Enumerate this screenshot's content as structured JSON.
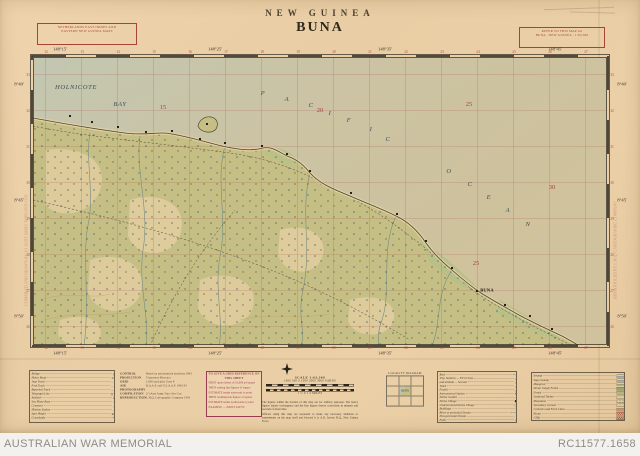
{
  "header": {
    "country": "NEW GUINEA",
    "title": "BUNA",
    "series_note_lines": [
      "NETHERLANDS EAST INDIES AND",
      "EASTERN NEW GUINEA MAPS"
    ],
    "refer_note_lines": [
      "REFER TO THIS MAP AS",
      "BUNA . NEW GUINEA . 1:63,360"
    ]
  },
  "map": {
    "float_labels": [
      {
        "t": "HOLNICOTE",
        "x": 76,
        "y": 87,
        "c": "sea"
      },
      {
        "t": "BAY",
        "x": 120,
        "y": 104,
        "c": "sea"
      },
      {
        "t": "P",
        "x": 263,
        "y": 93,
        "c": "sea"
      },
      {
        "t": "A",
        "x": 287,
        "y": 99,
        "c": "sea"
      },
      {
        "t": "C",
        "x": 311,
        "y": 105,
        "c": "sea"
      },
      {
        "t": "I",
        "x": 330,
        "y": 113,
        "c": "sea"
      },
      {
        "t": "F",
        "x": 349,
        "y": 120,
        "c": "sea"
      },
      {
        "t": "I",
        "x": 371,
        "y": 129,
        "c": "sea"
      },
      {
        "t": "C",
        "x": 388,
        "y": 139,
        "c": "sea"
      },
      {
        "t": "O",
        "x": 449,
        "y": 171,
        "c": "sea"
      },
      {
        "t": "C",
        "x": 470,
        "y": 184,
        "c": "sea"
      },
      {
        "t": "E",
        "x": 489,
        "y": 197,
        "c": "sea"
      },
      {
        "t": "A",
        "x": 508,
        "y": 210,
        "c": "sea"
      },
      {
        "t": "N",
        "x": 528,
        "y": 224,
        "c": "sea"
      },
      {
        "t": "15",
        "x": 163,
        "y": 107,
        "c": "grid"
      },
      {
        "t": "20",
        "x": 320,
        "y": 110,
        "c": "grid"
      },
      {
        "t": "25",
        "x": 469,
        "y": 104,
        "c": "grid"
      },
      {
        "t": "30",
        "x": 552,
        "y": 187,
        "c": "grid"
      },
      {
        "t": "25",
        "x": 476,
        "y": 263,
        "c": "grid"
      },
      {
        "t": "BUNA",
        "x": 487,
        "y": 290,
        "c": "place"
      },
      {
        "t": "148°15'",
        "x": 60,
        "y": 49,
        "c": "coord"
      },
      {
        "t": "148°25'",
        "x": 215,
        "y": 49,
        "c": "coord"
      },
      {
        "t": "148°35'",
        "x": 385,
        "y": 49,
        "c": "coord"
      },
      {
        "t": "148°45'",
        "x": 555,
        "y": 49,
        "c": "coord"
      },
      {
        "t": "148°15'",
        "x": 60,
        "y": 353,
        "c": "coord"
      },
      {
        "t": "148°25'",
        "x": 215,
        "y": 353,
        "c": "coord"
      },
      {
        "t": "148°35'",
        "x": 385,
        "y": 353,
        "c": "coord"
      },
      {
        "t": "148°45'",
        "x": 555,
        "y": 353,
        "c": "coord"
      },
      {
        "t": "8°40'",
        "x": 19,
        "y": 84,
        "c": "coord"
      },
      {
        "t": "8°45'",
        "x": 19,
        "y": 200,
        "c": "coord"
      },
      {
        "t": "8°50'",
        "x": 19,
        "y": 316,
        "c": "coord"
      },
      {
        "t": "8°40'",
        "x": 622,
        "y": 84,
        "c": "coord"
      },
      {
        "t": "8°45'",
        "x": 622,
        "y": 200,
        "c": "coord"
      },
      {
        "t": "8°50'",
        "x": 622,
        "y": 316,
        "c": "coord"
      },
      {
        "t": "COMPILED AND DRAWN BY 2/1 AUST ARMY TOPO SVY COY",
        "x": 26,
        "y": 250,
        "c": "vert"
      },
      {
        "t": "REPRODUCED BY L.H.Q. CARTOGRAPHIC COMPANY",
        "x": 615,
        "y": 250,
        "c": "vert"
      }
    ],
    "edge_numbers": {
      "horizontal": {
        "x0": 46,
        "dx": 36,
        "n": 16,
        "v0": 12,
        "step": 1,
        "ys": [
          52,
          348
        ]
      },
      "vertical": {
        "y0": 75,
        "dy": 36,
        "n": 8,
        "v0": 33,
        "step": -1,
        "xs": [
          28,
          612
        ]
      }
    },
    "villages": [
      [
        70,
        116
      ],
      [
        92,
        122
      ],
      [
        118,
        127
      ],
      [
        146,
        132
      ],
      [
        172,
        131
      ],
      [
        200,
        139
      ],
      [
        225,
        143
      ],
      [
        262,
        146
      ],
      [
        287,
        154
      ],
      [
        310,
        171
      ],
      [
        351,
        193
      ],
      [
        397,
        214
      ],
      [
        426,
        241
      ],
      [
        452,
        268
      ],
      [
        477,
        291
      ],
      [
        505,
        305
      ],
      [
        530,
        316
      ],
      [
        552,
        329
      ],
      [
        207,
        124
      ]
    ]
  },
  "legend_left": {
    "rows": [
      {
        "label": "Bridge",
        "sym": "bridge"
      },
      {
        "label": "Motor Road",
        "sym": "road"
      },
      {
        "label": "Jeep Track",
        "sym": "jeep"
      },
      {
        "label": "Foot Track",
        "sym": "foot"
      },
      {
        "label": "Reported Track",
        "sym": "reported"
      },
      {
        "label": "Telegraph Line",
        "sym": "telegraph"
      },
      {
        "label": "Airfield",
        "sym": "airfield"
      },
      {
        "label": "Sea Plane Base",
        "sym": "seaplane",
        "c": "blue"
      },
      {
        "label": "Cemetery",
        "sym": "cemetery"
      },
      {
        "label": "Mission Station",
        "sym": "mission"
      },
      {
        "label": "Spot Height",
        "sym": "spot"
      },
      {
        "label": "Grasslands",
        "sym": "grass"
      }
    ]
  },
  "notes": {
    "rows": [
      {
        "label": "CONTROL",
        "value": "Based on astronomical positions 1943"
      },
      {
        "label": "PROJECTION",
        "value": "Transverse Mercator"
      },
      {
        "label": "GRID",
        "value": "1,000 yard grid, Zone 8"
      },
      {
        "label": "AIR PHOTOGRAPHY",
        "value": "R.A.A.F. and U.S.A.A.F. 1942-43"
      },
      {
        "label": "COMPILATION",
        "value": "2/1 Aust Army Topo Svy Coy"
      },
      {
        "label": "REPRODUCTION",
        "value": "L.H.Q. Cartographic Company 1943"
      }
    ]
  },
  "gridref": {
    "heading": "TO GIVE A GRID REFERENCE ON THIS SHEET",
    "lines": [
      "FIRST quote letters of 10,000 yd square",
      "THEN easting line figures of square",
      "ESTIMATE tenths eastwards to point",
      "THEN northing line figures of square",
      "ESTIMATE tenths northwards to point",
      "EXAMPLE — POINT 243752"
    ]
  },
  "scale": {
    "heading": "SCALE 1:63,360",
    "yards_row": "1000  500  0  1000  2000  3000  YARDS",
    "miles_row": "1  ½  0  1  2  MILES",
    "para1": "The figures within the borders of this map are for artillery purposes. The heavy figures denote convergence and the fine figures denote corrections in minutes and seconds of mean time.",
    "para2": "Officers using this map are requested to make any necessary additions or amendments on the map itself and forward it to A.D. Survey H.Q., New Guinea Force."
  },
  "locality": {
    "caption": "LOCALITY DIAGRAM",
    "current": "BUNA"
  },
  "legend_right": {
    "rows": [
      {
        "label": "Reef",
        "sym": "reef",
        "c": "blue"
      },
      {
        "label": "Trig. Stations — First Class",
        "sym": "trig"
      },
      {
        "label": "and altitude — Second",
        "sym": "trig"
      },
      {
        "label": "Third",
        "sym": "trig"
      },
      {
        "label": "Fourth",
        "sym": "trig"
      },
      {
        "label": "Astronomical Station",
        "sym": "astro"
      },
      {
        "label": "Native Garden",
        "sym": "garden"
      },
      {
        "label": "Native Village",
        "sym": "village"
      },
      {
        "label": "Undetermined Native Village",
        "sym": "uvillage"
      },
      {
        "label": "Buildings",
        "sym": "bldg"
      },
      {
        "label": "River or perennial Stream",
        "sym": "river",
        "c": "blue"
      },
      {
        "label": "Non-perennial Stream",
        "sym": "nstream",
        "c": "blue"
      },
      {
        "label": "Falls",
        "sym": "falls",
        "c": "blue"
      }
    ]
  },
  "legend_veg": {
    "rows": [
      {
        "label": "Swamp",
        "color": "#4e7ca0",
        "kind": "tufts"
      },
      {
        "label": "Sago Swamp",
        "color": "#4e7ca0",
        "kind": "tufts"
      },
      {
        "label": "Mangrove",
        "color": "#3f7a5e",
        "kind": "tufts"
      },
      {
        "label": "Dense Jungle Forest",
        "color": "#97a86b",
        "kind": "tint"
      },
      {
        "label": "Forest",
        "color": "#aeb97f",
        "kind": "tint"
      },
      {
        "label": "Scattered Timber",
        "color": "#9fae72",
        "kind": "dots"
      },
      {
        "label": "Plantation",
        "color": "#3f6a46",
        "kind": "dots"
      },
      {
        "label": "Secondary Growth",
        "color": "#7e9a5a",
        "kind": "dots"
      },
      {
        "label": "Contours and Form Lines",
        "color": "#a4603c",
        "kind": "lines"
      },
      {
        "label": "Kunai",
        "color": "#b04a3a",
        "kind": "hatch"
      },
      {
        "label": "Cliffs",
        "color": "#8a4a34",
        "kind": "hatch"
      }
    ]
  },
  "footer": {
    "left": "AUSTRALIAN WAR MEMORIAL",
    "right": "RC11577.1658"
  }
}
